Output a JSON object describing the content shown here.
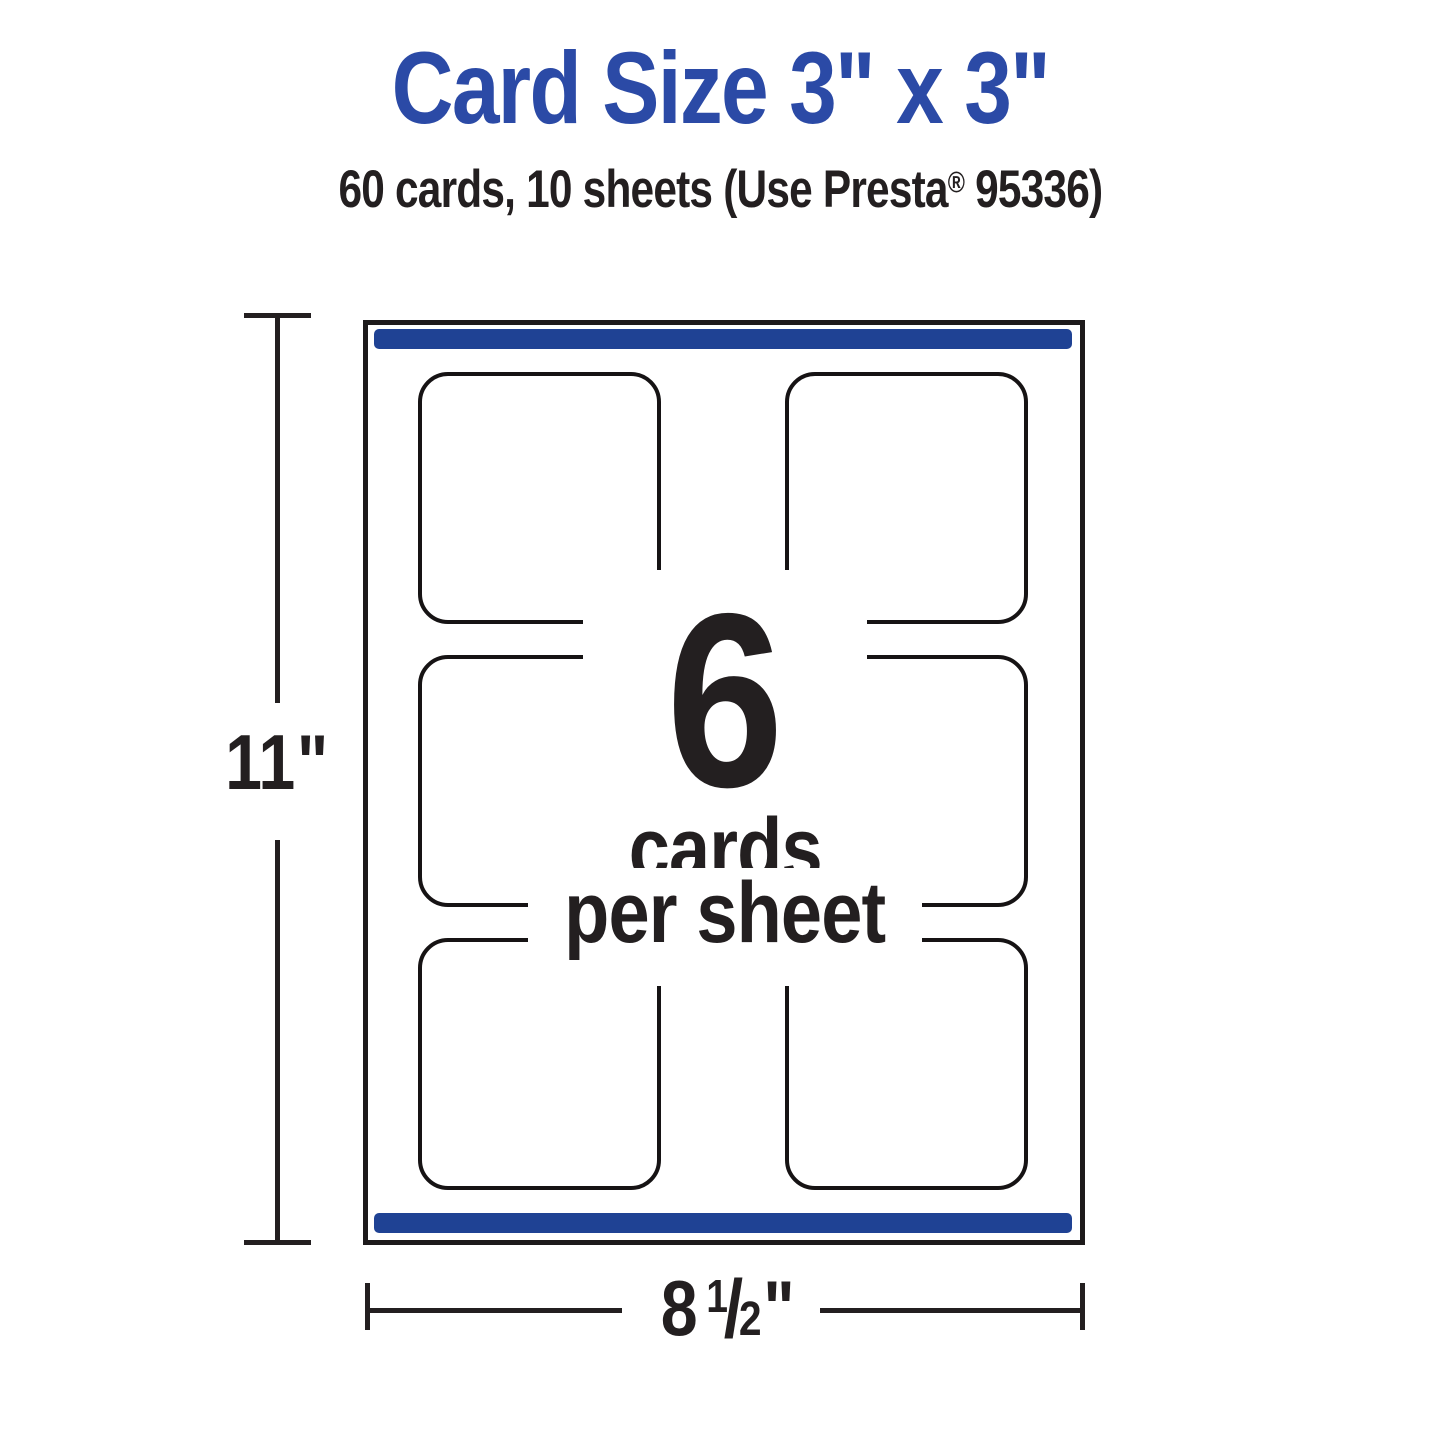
{
  "colors": {
    "title_blue": "#2B4AA6",
    "bar_blue": "#1F4294",
    "ink": "#231F20"
  },
  "header": {
    "title": "Card Size 3\" x 3\"",
    "subtitle_pre": "60 cards, 10 sheets (Use Presta",
    "subtitle_reg": "®",
    "subtitle_post": " 95336)"
  },
  "sheet": {
    "count": "6",
    "cards_word": "cards",
    "per_sheet_word": "per sheet",
    "rows": 3,
    "columns": 2,
    "card_slots": 6
  },
  "dimensions": {
    "height": {
      "value": "11",
      "unit": "\""
    },
    "width": {
      "whole": "8",
      "numerator": "1",
      "slash": "/",
      "denominator": "2",
      "unit": "\""
    }
  }
}
